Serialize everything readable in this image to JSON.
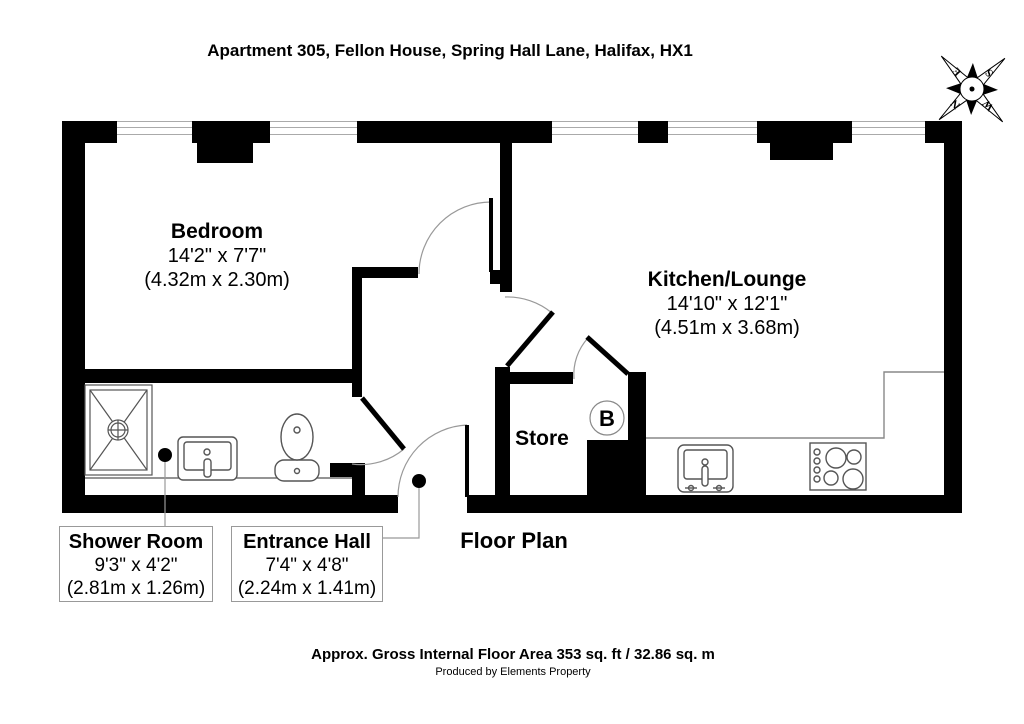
{
  "title": "Apartment 305, Fellon House, Spring Hall Lane, Halifax, HX1",
  "rooms": {
    "bedroom": {
      "name": "Bedroom",
      "imperial": "14'2\" x 7'7\"",
      "metric": "(4.32m x 2.30m)"
    },
    "kitchen": {
      "name": "Kitchen/Lounge",
      "imperial": "14'10\" x 12'1\"",
      "metric": "(4.51m x 3.68m)"
    },
    "store": {
      "name": "Store"
    },
    "shower": {
      "name": "Shower Room",
      "imperial": "9'3\" x 4'2\"",
      "metric": "(2.81m x 1.26m)"
    },
    "hall": {
      "name": "Entrance Hall",
      "imperial": "7'4\" x 4'8\"",
      "metric": "(2.24m x 1.41m)"
    }
  },
  "labels": {
    "floor_plan": "Floor Plan",
    "boiler": "B"
  },
  "compass": {
    "n": "N",
    "e": "E",
    "s": "S",
    "w": "W"
  },
  "footer": {
    "area": "Approx. Gross Internal Floor Area 353 sq. ft / 32.86 sq. m",
    "credit": "Produced by Elements Property"
  },
  "colors": {
    "wall": "#000000",
    "window_line": "#aaaaaa",
    "door_arc": "#999999",
    "fixture": "#555555"
  }
}
